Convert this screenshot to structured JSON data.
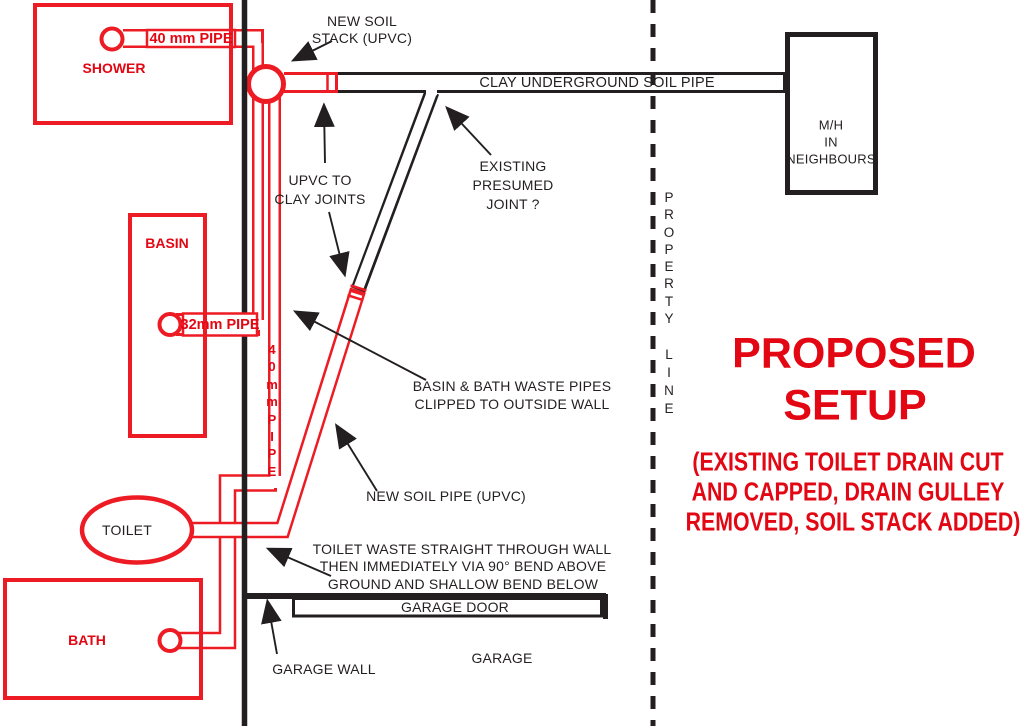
{
  "colors": {
    "red": "#e30613",
    "pipe_red": "#ed1c24",
    "black": "#231f20"
  },
  "title": {
    "line1": "PROPOSED",
    "line2": "SETUP",
    "note_line1": "(EXISTING TOILET DRAIN CUT",
    "note_line2": "AND CAPPED, DRAIN GULLEY",
    "note_line3": "REMOVED, SOIL STACK ADDED)"
  },
  "fixtures": {
    "shower": "SHOWER",
    "basin": "BASIN",
    "toilet": "TOILET",
    "bath": "BATH",
    "manhole_line1": "M/H",
    "manhole_line2": "IN",
    "manhole_line3": "NEIGHBOURS"
  },
  "pipe_labels": {
    "shower_pipe": "40 mm PIPE",
    "basin_pipe": "32mm PIPE",
    "riser_pipe": "40mmPIPE",
    "clay_pipe": "CLAY UNDERGROUND SOIL PIPE"
  },
  "annotations": {
    "soil_stack_line1": "NEW SOIL",
    "soil_stack_line2": "STACK (UPVC)",
    "upvc_joints_line1": "UPVC TO",
    "upvc_joints_line2": "CLAY JOINTS",
    "existing_joint_line1": "EXISTING",
    "existing_joint_line2": "PRESUMED",
    "existing_joint_line3": "JOINT ?",
    "clipped_line1": "BASIN & BATH WASTE PIPES",
    "clipped_line2": "CLIPPED TO OUTSIDE WALL",
    "new_soil_pipe": "NEW SOIL PIPE (UPVC)",
    "toilet_waste_line1": "TOILET WASTE STRAIGHT THROUGH WALL",
    "toilet_waste_line2": "THEN IMMEDIATELY VIA 90° BEND ABOVE",
    "toilet_waste_line3": "GROUND AND SHALLOW BEND BELOW"
  },
  "garage": {
    "door": "GARAGE DOOR",
    "room": "GARAGE",
    "wall": "GARAGE WALL"
  },
  "property_line": {
    "word1": "PROPERTY",
    "word2": "LINE"
  }
}
